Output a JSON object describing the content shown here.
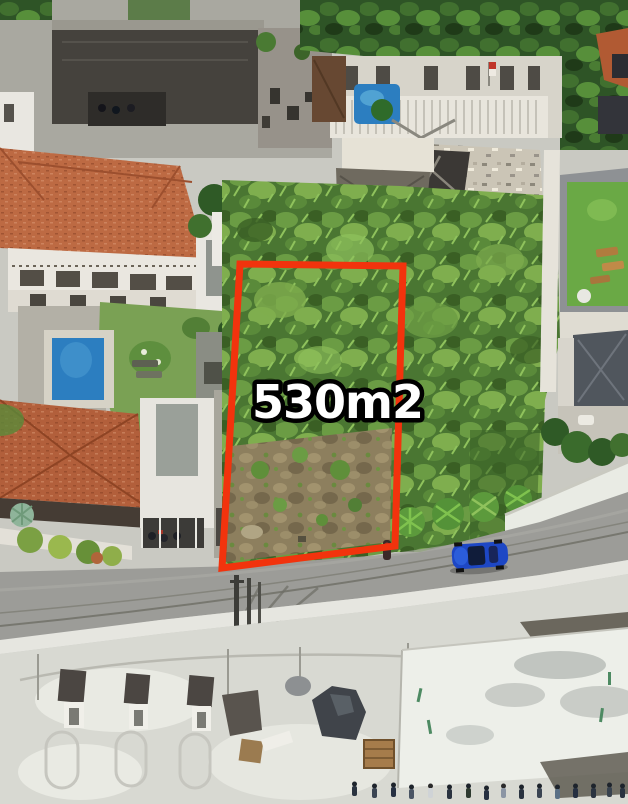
{
  "photo": {
    "kind": "aerial-drone-land-listing",
    "plot": {
      "area_label": "530m2",
      "outline_color": "#f2330d"
    },
    "palette": {
      "label_fill": "#ffffff",
      "label_outline": "#000000",
      "vegetation_base": "#4a7632",
      "roof_tile": "#bd6a43",
      "road": "#9c9c98",
      "pool": "#2c7ec0",
      "ground": "#d8d9d2",
      "car": "#1d47c5"
    }
  }
}
